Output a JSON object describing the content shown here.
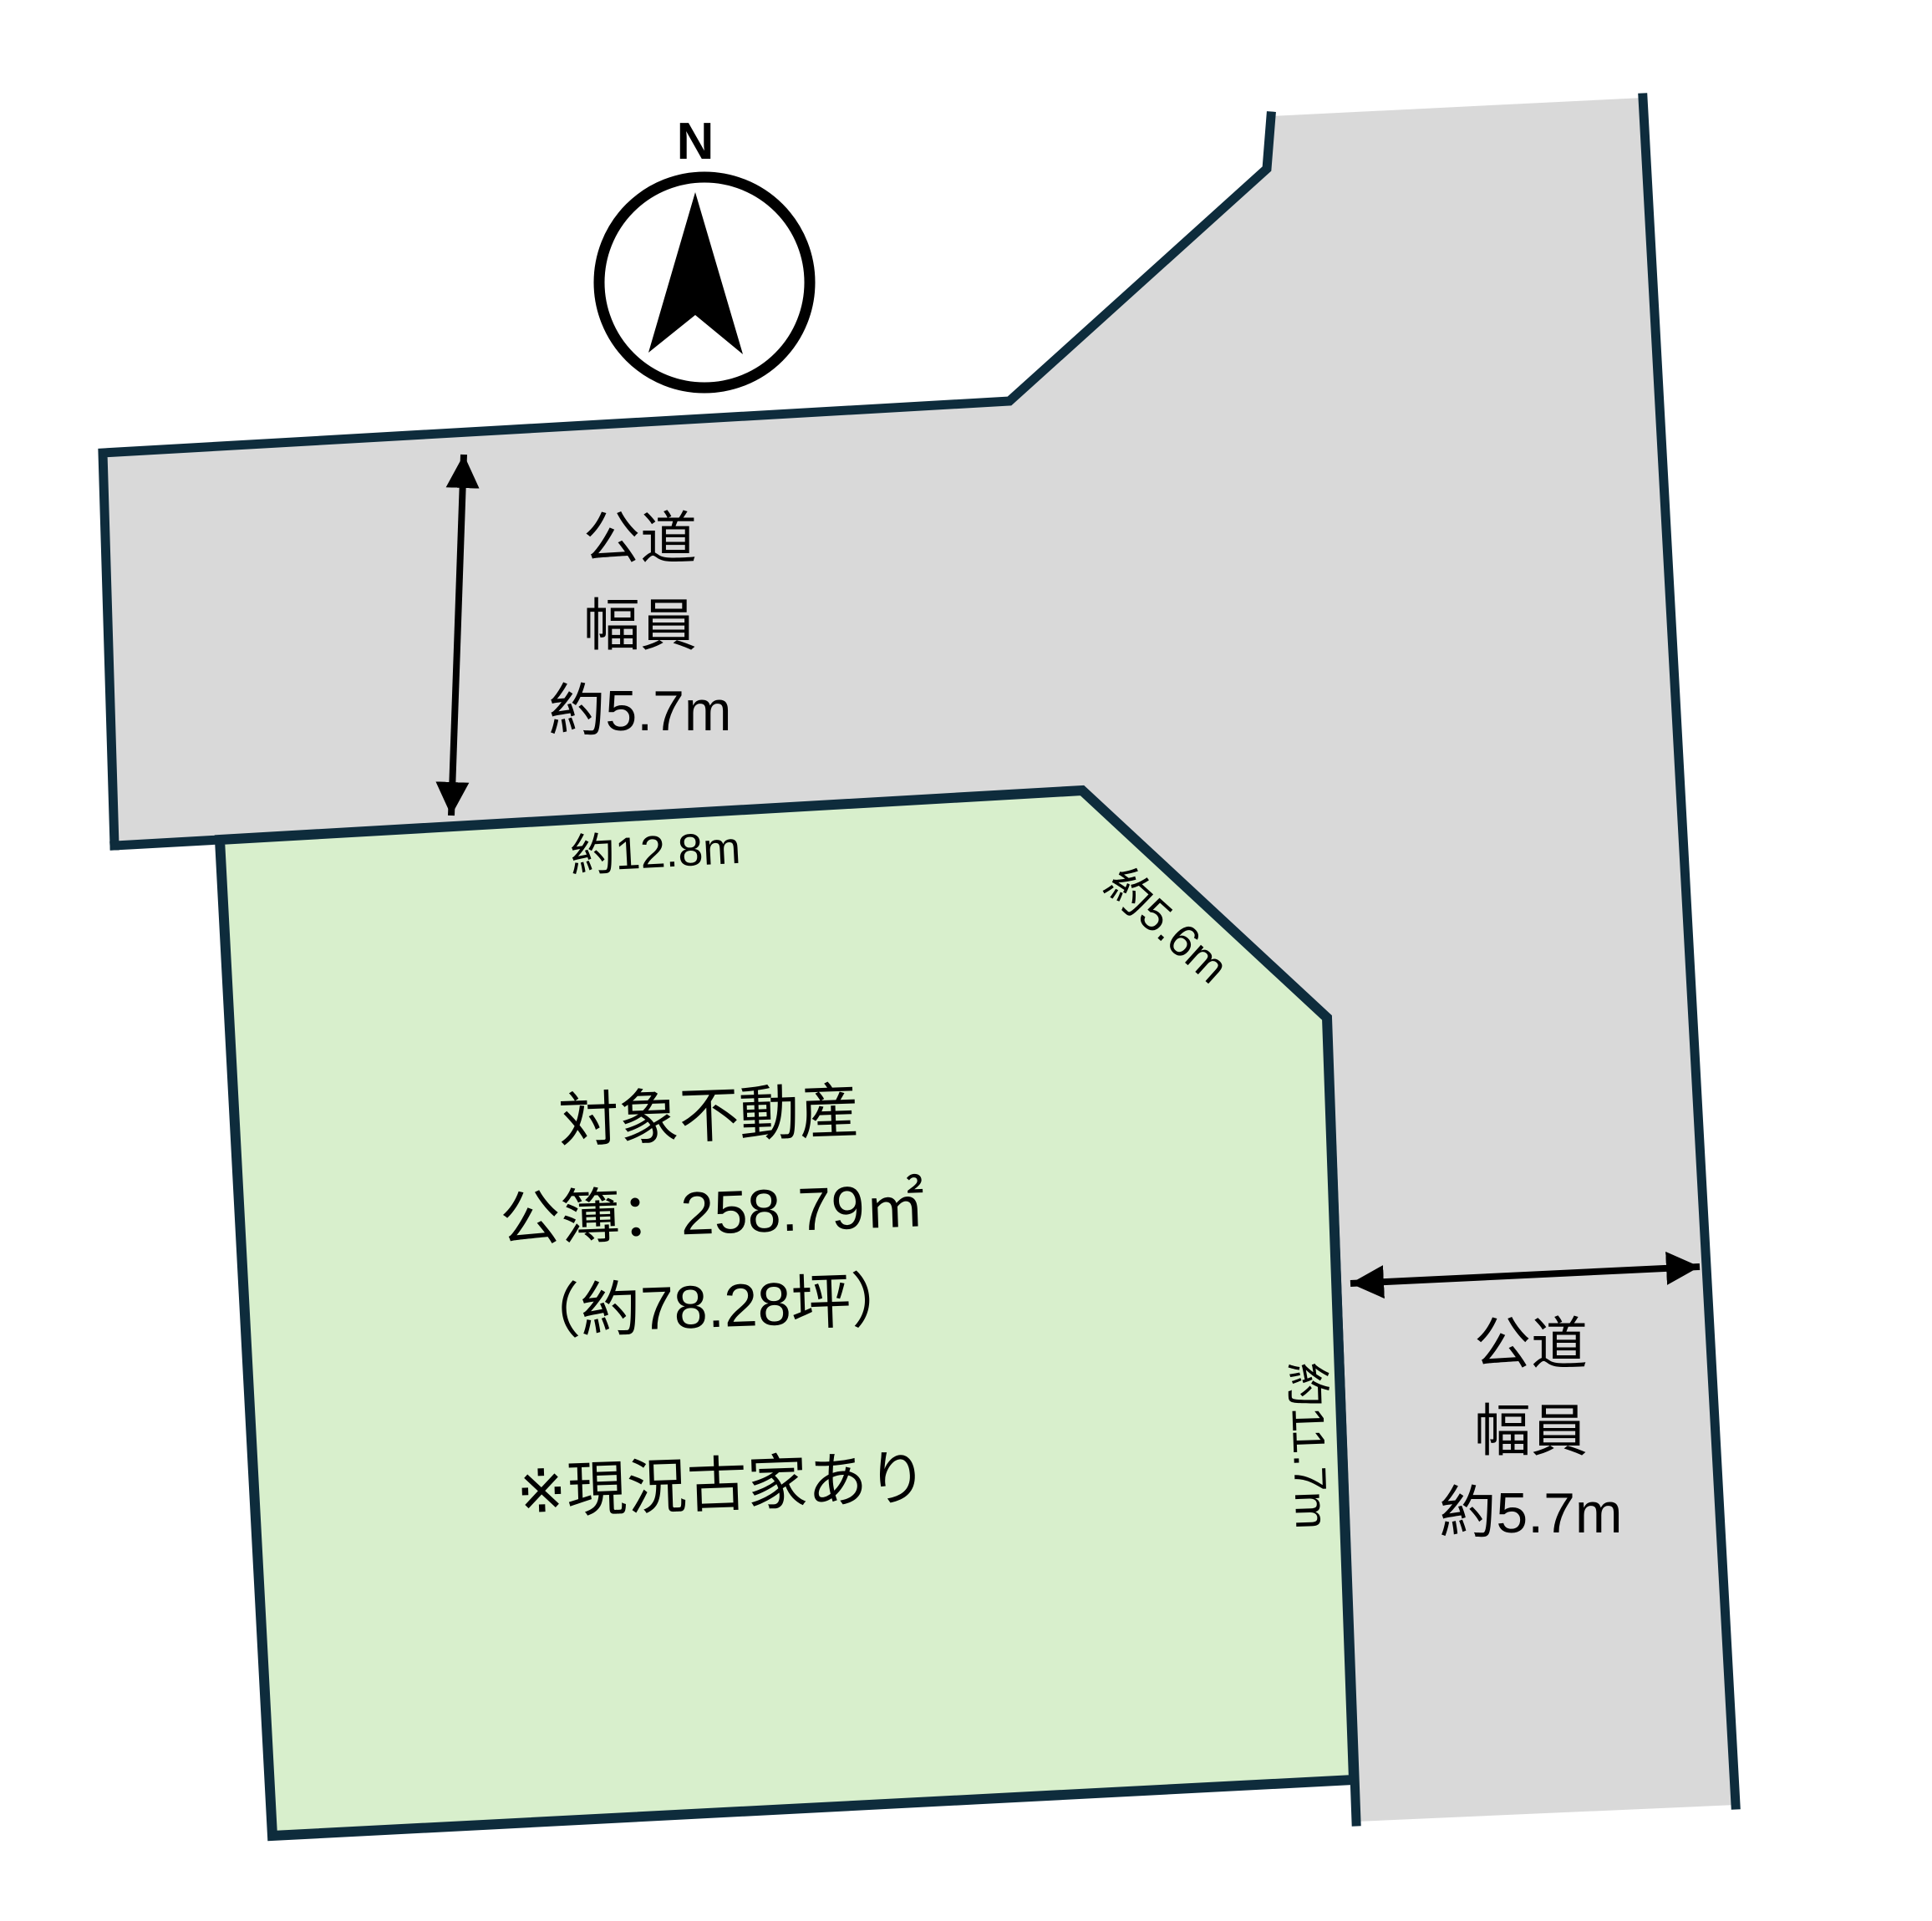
{
  "compass": {
    "north_label": "N"
  },
  "plot": {
    "title": "対象不動産",
    "registered_area": "公簿：258.79㎡",
    "area_tsubo": "（約78.28坪）",
    "note": "※現況古家あり",
    "frontage_top_edge": "約12.8m",
    "frontage_diagonal_edge": "約5.6m",
    "frontage_right_edge": "約11.7m"
  },
  "road_left": {
    "name": "公道",
    "width_label": "幅員",
    "width_value": "約5.7m"
  },
  "road_right": {
    "name": "公道",
    "width_label": "幅員",
    "width_value": "約5.7m"
  },
  "colors": {
    "plot_fill": "#d8efcc",
    "road_fill": "#d9d9d9",
    "boundary": "#0e2c3c",
    "arrow": "#000000"
  }
}
